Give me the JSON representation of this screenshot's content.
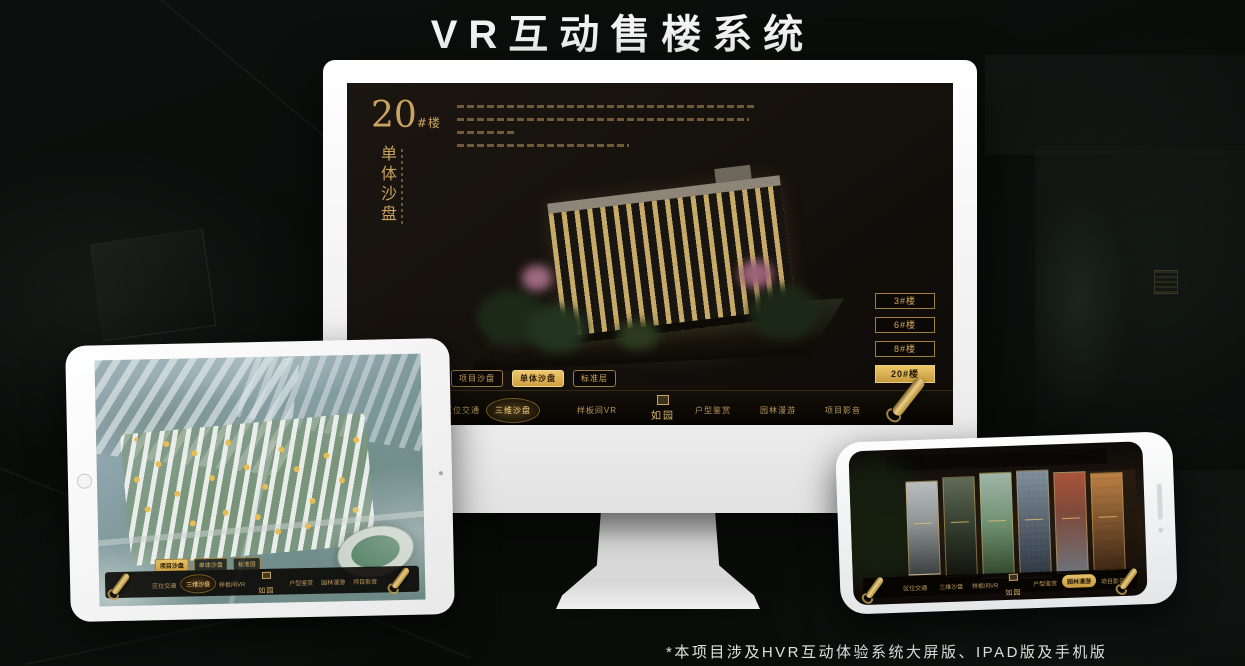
{
  "page": {
    "title": "VR互动售楼系统",
    "footnote": "*本项目涉及HVR互动体验系统大屏版、IPAD版及手机版"
  },
  "colors": {
    "gold": "#c9a35f",
    "gold_bright": "#eac668",
    "screen_bg": "#14100c",
    "device_white": "#f2f2f2"
  },
  "sales_app": {
    "logo": "如园",
    "nav_items": [
      "区位交通",
      "三维沙盘",
      "样板间VR",
      "户型鉴赏",
      "园林漫游",
      "项目影音"
    ],
    "tabs": [
      "项目沙盘",
      "单体沙盘",
      "标准层"
    ]
  },
  "monitor_screen": {
    "heading_number": "20",
    "heading_unit": "#楼",
    "heading_title": "单体沙盘",
    "floor_buttons": [
      "3#楼",
      "6#楼",
      "8#楼",
      "20#楼"
    ],
    "active_floor": "20#楼",
    "active_tab": "单体沙盘",
    "active_nav": "三维沙盘"
  },
  "tablet_screen": {
    "active_tab": "项目沙盘",
    "active_nav": "三维沙盘"
  },
  "phone_screen": {
    "active_nav": "园林漫游"
  }
}
